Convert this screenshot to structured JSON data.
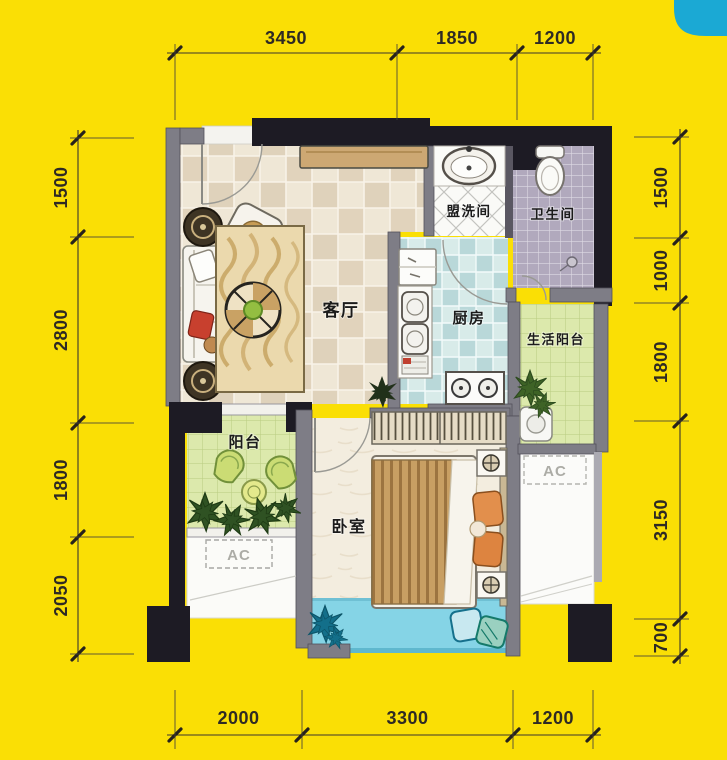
{
  "rooms": {
    "living": "客厅",
    "washroom": "盟洗间",
    "bathroom": "卫生间",
    "kitchen": "厨房",
    "service_balcony": "生活阳台",
    "balcony": "阳台",
    "bedroom": "卧室",
    "ac_left": "AC",
    "ac_right": "AC"
  },
  "dimensions": {
    "top": [
      "3450",
      "1850",
      "1200"
    ],
    "bottom": [
      "2000",
      "3300",
      "1200"
    ],
    "left": [
      "1500",
      "2800",
      "1800",
      "2050"
    ],
    "right": [
      "1500",
      "1000",
      "1800",
      "3150",
      "700"
    ]
  },
  "colors": {
    "background": "#FADF05",
    "corner_accent": "#1BA9D4",
    "wall_dark": "#1D1B24",
    "wall_gray": "#7E7D86",
    "balcony_floor": "#DCE9AC",
    "kitchen_floor": "#C9E1E0",
    "bath_floor": "#B1A9BD",
    "bay_window": "#85D4E6"
  }
}
